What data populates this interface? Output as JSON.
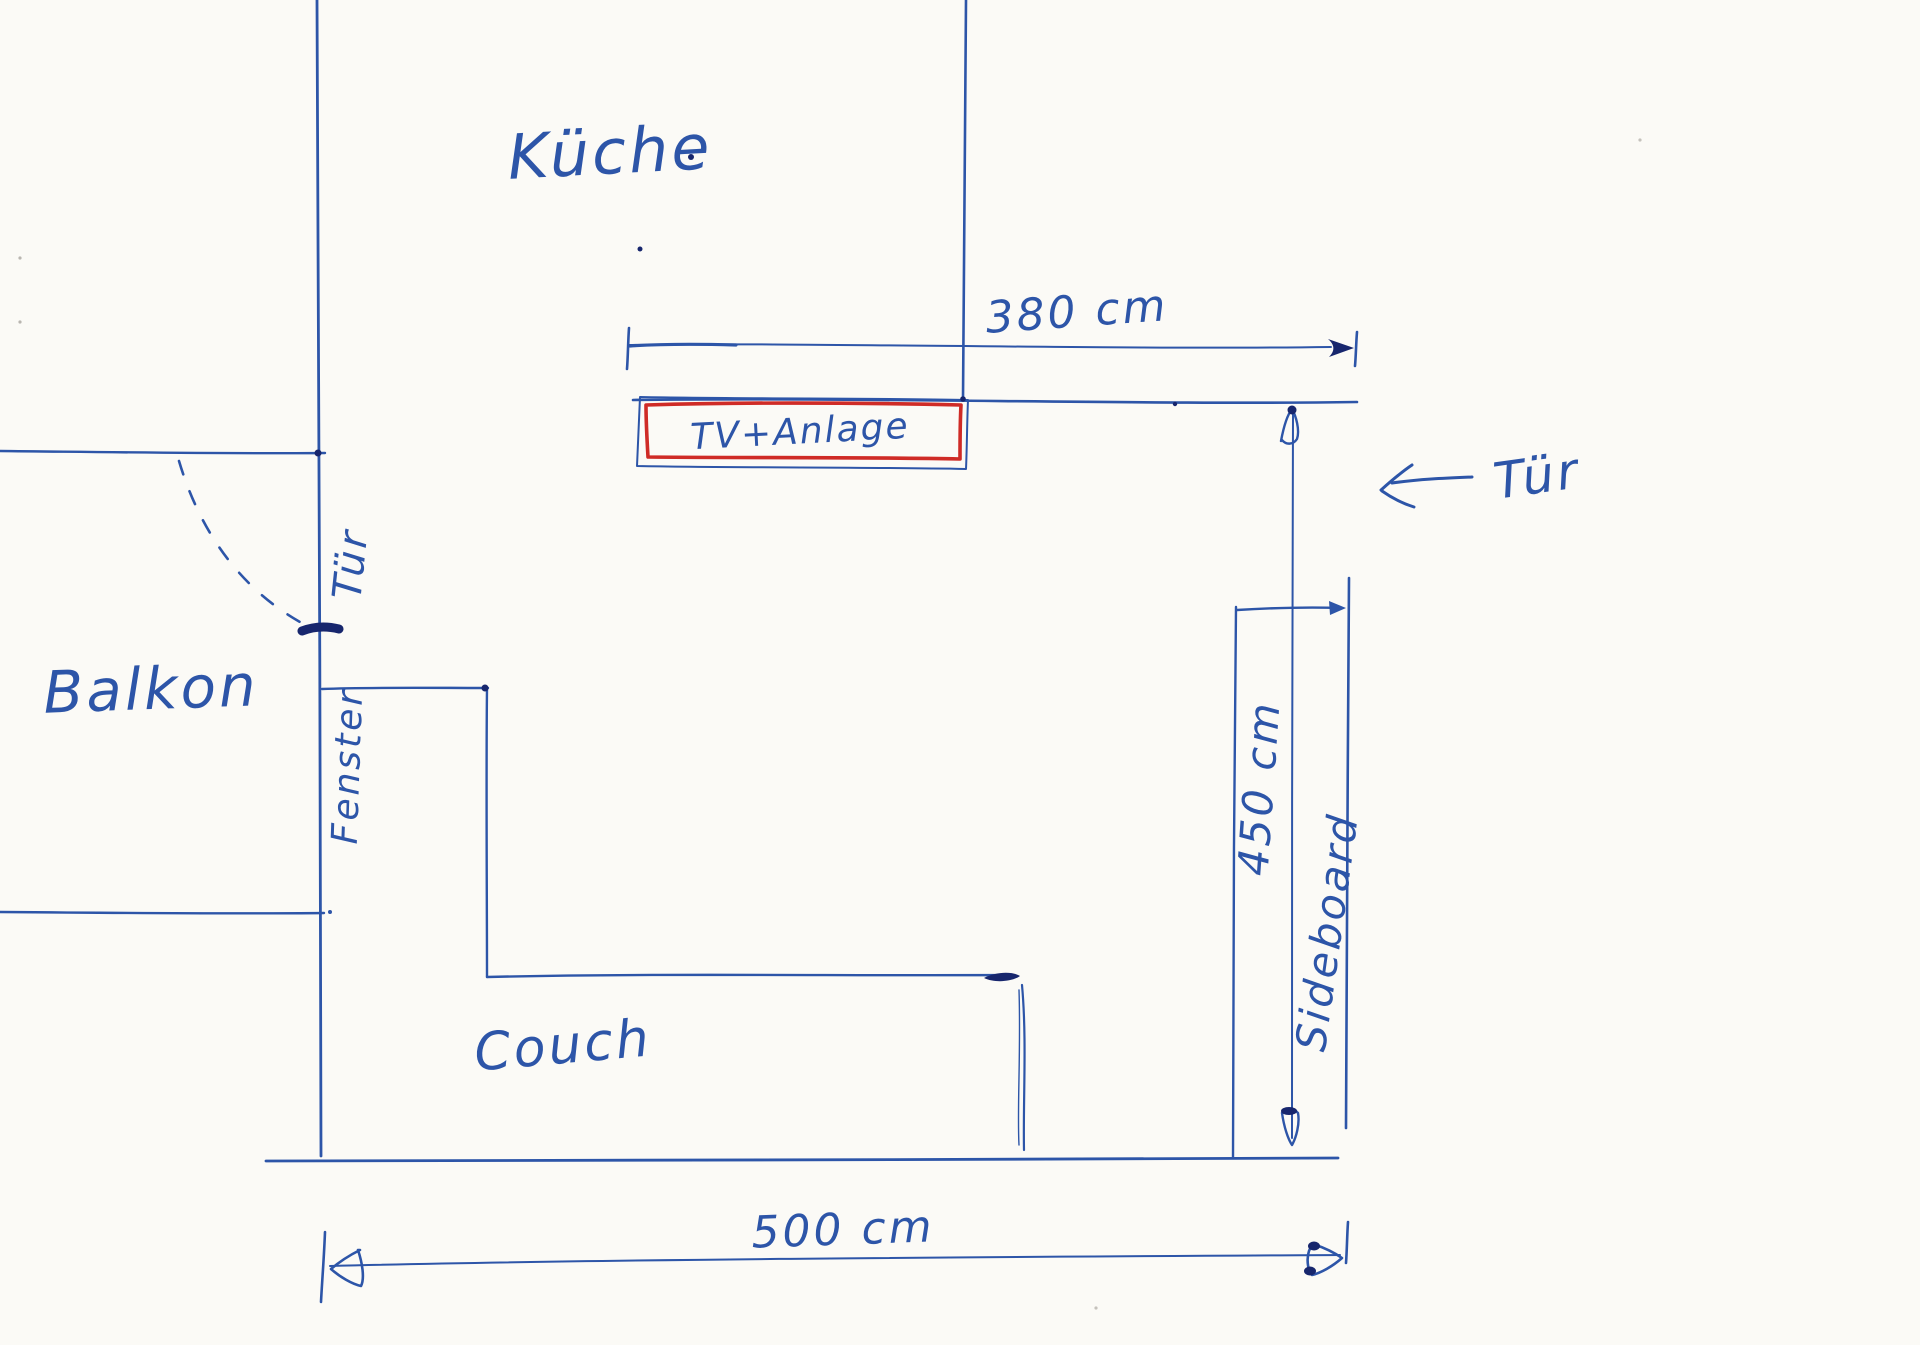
{
  "labels": {
    "kitchen": "Küche",
    "balcony": "Balkon",
    "couch": "Couch",
    "sideboard": "Sideboard",
    "tv_unit": "TV+Anlage",
    "window": "Fenster",
    "balcony_door": "Tür",
    "entry_door": "Tür"
  },
  "dimensions": {
    "tv_wall_width": "380 cm",
    "room_depth": "450 cm",
    "room_width": "500 cm"
  },
  "colors": {
    "ink_blue": "#2d55a8",
    "ink_dark_blue": "#17266d",
    "ink_red": "#cf2b26",
    "paper": "#fbfaf6"
  }
}
